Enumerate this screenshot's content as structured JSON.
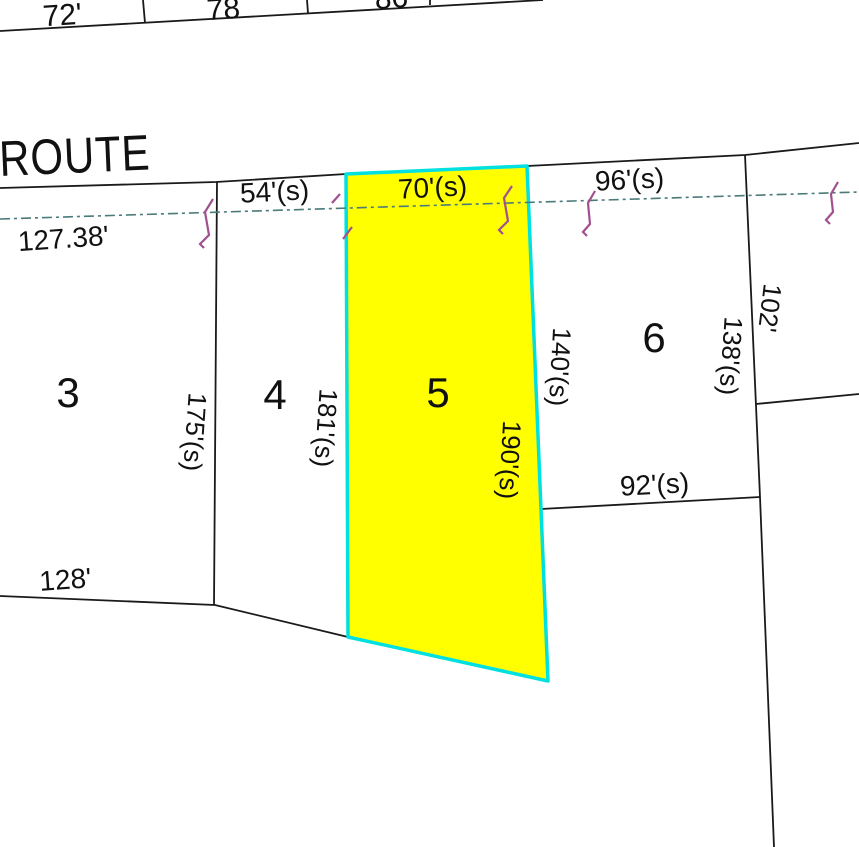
{
  "labels": {
    "route": "ROUTE",
    "across_street": [
      "72'",
      "78",
      "86"
    ],
    "lot_numbers": [
      "3",
      "4",
      "5",
      "6"
    ],
    "frontages": {
      "lot3": "127.38'",
      "lot4": "54'(s)",
      "lot5": "70'(s)",
      "lot6": "96'(s)"
    },
    "depths": {
      "lot3_lot4": "175'(s)",
      "lot4_lot5": "181'(s)",
      "lot5_east": "190'(s)",
      "lot6_west": "140'(s)",
      "lot6_east": "138'(s)",
      "east_parcel": "102'"
    },
    "rears": {
      "lot3": "128'",
      "lot6": "92'(s)"
    }
  },
  "selected_lot": "5",
  "colors": {
    "highlight_fill": "#ffff00",
    "highlight_stroke": "#00e0e0",
    "tie_line": "#4a7a7a",
    "pin_marker": "#a0508f",
    "boundary": "#1a1a1a"
  }
}
